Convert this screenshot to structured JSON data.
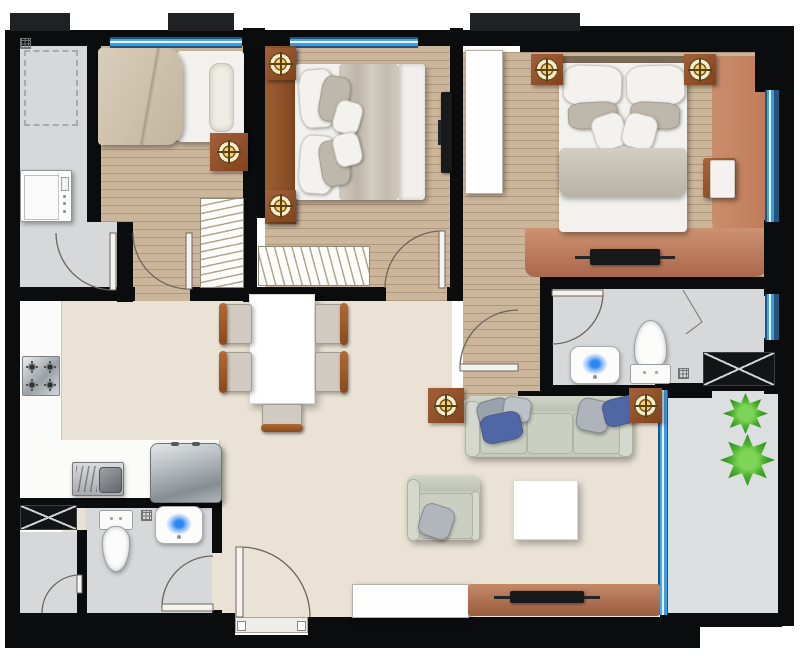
{
  "meta": {
    "canvas": {
      "w": 800,
      "h": 667
    },
    "view": "apartment-floor-plan-top-view"
  },
  "palette": {
    "wall": "#0b0c0d",
    "window_blue": "#3d9be0",
    "wood_floor": "#cbb69b",
    "tile_floor": "#d6d8da",
    "living_floor": "#eae3d5",
    "balcony_floor": "#dcdfe0",
    "accent_wood": "#a2613a",
    "light_gold": "#f6d164",
    "sofa_fabric": "#c6cabc",
    "pillow_blue": "#4f68a5",
    "plant_green": "#35961f",
    "rug_salmon": "#bf7a57"
  },
  "floorplan": {
    "floors": [
      {
        "n": "utility-room-floor",
        "c": "fl-gray",
        "x": 20,
        "y": 35,
        "w": 98,
        "h": 266
      },
      {
        "n": "bedroom1-floor",
        "c": "fl-wood",
        "x": 101,
        "y": 45,
        "w": 142,
        "h": 257
      },
      {
        "n": "vestibule-floor",
        "c": "fl-gray",
        "x": 101,
        "y": 222,
        "w": 32,
        "h": 80
      },
      {
        "n": "bedroom2-floor",
        "c": "fl-wood",
        "x": 265,
        "y": 44,
        "w": 185,
        "h": 258
      },
      {
        "n": "master-bedroom-floor",
        "c": "fl-wood",
        "x": 463,
        "y": 52,
        "w": 315,
        "h": 237
      },
      {
        "n": "hallway-floor",
        "c": "fl-wood",
        "x": 463,
        "y": 289,
        "w": 77,
        "h": 111
      },
      {
        "n": "bathroom1-floor",
        "c": "fl-gray",
        "x": 553,
        "y": 289,
        "w": 225,
        "h": 97
      },
      {
        "n": "living-floor-upper",
        "c": "fl-beige",
        "x": 62,
        "y": 301,
        "w": 390,
        "h": 99
      },
      {
        "n": "living-floor-main",
        "c": "fl-beige",
        "x": 62,
        "y": 400,
        "w": 597,
        "h": 230
      },
      {
        "n": "balcony-floor",
        "c": "fl-balcony",
        "x": 668,
        "y": 391,
        "w": 110,
        "h": 222
      },
      {
        "n": "kitchen-counter-vertical",
        "c": "fl-counter",
        "x": 20,
        "y": 298,
        "w": 42,
        "h": 202
      },
      {
        "n": "kitchen-counter-horizontal",
        "c": "fl-counter",
        "x": 20,
        "y": 440,
        "w": 200,
        "h": 60
      },
      {
        "n": "bathroom2-floor",
        "c": "fl-gray",
        "x": 85,
        "y": 503,
        "w": 127,
        "h": 115
      },
      {
        "n": "shower-room-floor",
        "c": "fl-gray",
        "x": 20,
        "y": 532,
        "w": 57,
        "h": 86
      },
      {
        "n": "master-rug-column",
        "c": "salmon-col",
        "x": 712,
        "y": 56,
        "w": 58,
        "h": 184
      },
      {
        "n": "master-rug-band",
        "c": "salmon-band",
        "x": 525,
        "y": 228,
        "w": 245,
        "h": 49
      }
    ],
    "walls": [
      {
        "n": "wall-left",
        "x": 5,
        "y": 30,
        "w": 15,
        "h": 618
      },
      {
        "n": "wall-top-a",
        "x": 5,
        "y": 30,
        "w": 515,
        "h": 16
      },
      {
        "n": "wall-top-b",
        "x": 520,
        "y": 26,
        "w": 272,
        "h": 26
      },
      {
        "n": "wall-right",
        "x": 778,
        "y": 26,
        "w": 16,
        "h": 600
      },
      {
        "n": "wall-corner-tr",
        "x": 755,
        "y": 26,
        "w": 39,
        "h": 66
      },
      {
        "n": "wall-right-mid",
        "x": 764,
        "y": 220,
        "w": 30,
        "h": 76
      },
      {
        "n": "wall-right-low",
        "x": 764,
        "y": 338,
        "w": 30,
        "h": 56
      },
      {
        "n": "wall-bottom-left",
        "x": 5,
        "y": 613,
        "w": 230,
        "h": 35
      },
      {
        "n": "wall-bottom-mid",
        "x": 308,
        "y": 617,
        "w": 392,
        "h": 31
      },
      {
        "n": "wall-under-entrance",
        "x": 235,
        "y": 635,
        "w": 75,
        "h": 13
      },
      {
        "n": "wall-balcony-bottom",
        "x": 660,
        "y": 613,
        "w": 122,
        "h": 14
      },
      {
        "n": "wall-utility-right",
        "x": 87,
        "y": 30,
        "w": 14,
        "h": 192
      },
      {
        "n": "wall-vestibule-right",
        "x": 117,
        "y": 222,
        "w": 16,
        "h": 80
      },
      {
        "n": "wall-utility-bottom",
        "x": 5,
        "y": 287,
        "w": 130,
        "h": 14
      },
      {
        "n": "wall-bed1-bed2",
        "x": 243,
        "y": 28,
        "w": 22,
        "h": 190
      },
      {
        "n": "wall-bed1-bed2-low",
        "x": 243,
        "y": 218,
        "w": 14,
        "h": 84
      },
      {
        "n": "wall-bed2-bottom",
        "x": 190,
        "y": 287,
        "w": 196,
        "h": 14
      },
      {
        "n": "wall-bed2-corner",
        "x": 447,
        "y": 287,
        "w": 16,
        "h": 14
      },
      {
        "n": "wall-bed2-master",
        "x": 450,
        "y": 28,
        "w": 13,
        "h": 260
      },
      {
        "n": "wall-hall-bath",
        "x": 540,
        "y": 288,
        "w": 13,
        "h": 112
      },
      {
        "n": "wall-master-bath",
        "x": 540,
        "y": 277,
        "w": 242,
        "h": 12
      },
      {
        "n": "wall-bath1-bottom",
        "x": 540,
        "y": 385,
        "w": 172,
        "h": 13
      },
      {
        "n": "wall-balcony-top",
        "x": 655,
        "y": 383,
        "w": 127,
        "h": 8
      },
      {
        "n": "wall-bath2-top",
        "x": 5,
        "y": 498,
        "w": 213,
        "h": 10
      },
      {
        "n": "wall-bath2-right-a",
        "x": 212,
        "y": 498,
        "w": 10,
        "h": 55
      },
      {
        "n": "wall-bath2-right-b",
        "x": 212,
        "y": 610,
        "w": 10,
        "h": 8
      },
      {
        "n": "wall-shower-divider",
        "x": 77,
        "y": 530,
        "w": 10,
        "h": 88
      },
      {
        "n": "wall-hall-bottom",
        "x": 518,
        "y": 391,
        "w": 24,
        "h": 9
      }
    ],
    "pillars": [
      {
        "x": 10,
        "y": 13,
        "w": 60,
        "h": 18
      },
      {
        "x": 168,
        "y": 13,
        "w": 66,
        "h": 18
      },
      {
        "x": 470,
        "y": 13,
        "w": 110,
        "h": 18
      }
    ],
    "windows": [
      {
        "n": "window-bedroom1",
        "x": 110,
        "y": 37,
        "w": 132,
        "h": 11,
        "o": "h"
      },
      {
        "n": "window-bedroom2",
        "x": 290,
        "y": 37,
        "w": 128,
        "h": 11,
        "o": "h"
      },
      {
        "n": "window-master",
        "x": 765,
        "y": 90,
        "w": 14,
        "h": 132,
        "o": "v"
      },
      {
        "n": "window-bathroom1",
        "x": 765,
        "y": 294,
        "w": 14,
        "h": 46,
        "o": "v"
      },
      {
        "n": "window-balcony",
        "x": 658,
        "y": 390,
        "w": 10,
        "h": 225,
        "o": "v"
      }
    ],
    "shafts": [
      {
        "n": "duct-shaft-bathroom1",
        "x": 703,
        "y": 352,
        "w": 72,
        "h": 34
      },
      {
        "n": "duct-shaft-bathroom2",
        "x": 20,
        "y": 505,
        "w": 57,
        "h": 25
      }
    ],
    "lights": [
      {
        "n": "ceiling-light-bedroom1",
        "x": 210,
        "y": 133,
        "w": 38,
        "h": 38
      },
      {
        "n": "ceiling-light-bedroom2-top",
        "x": 265,
        "y": 48,
        "w": 31,
        "h": 32
      },
      {
        "n": "ceiling-light-bedroom2-bottom",
        "x": 265,
        "y": 190,
        "w": 31,
        "h": 32
      },
      {
        "n": "ceiling-light-master-left",
        "x": 531,
        "y": 54,
        "w": 32,
        "h": 31
      },
      {
        "n": "ceiling-light-master-right",
        "x": 684,
        "y": 54,
        "w": 32,
        "h": 31
      },
      {
        "n": "ceiling-light-living-left",
        "x": 428,
        "y": 388,
        "w": 36,
        "h": 35
      },
      {
        "n": "ceiling-light-living-right",
        "x": 629,
        "y": 388,
        "w": 33,
        "h": 35
      }
    ],
    "doors": [
      {
        "n": "door-utility",
        "leaf": {
          "x": 110,
          "y": 233,
          "w": 6,
          "h": 57
        },
        "arc": "M113,290 A57 57 0 0 1 56,233"
      },
      {
        "n": "door-bedroom1",
        "leaf": {
          "x": 186,
          "y": 233,
          "w": 6,
          "h": 56
        },
        "arc": "M189,289 A56 56 0 0 1 133,233"
      },
      {
        "n": "door-bedroom2",
        "leaf": {
          "x": 439,
          "y": 231,
          "w": 6,
          "h": 57
        },
        "arc": "M442,231 A57 57 0 0 0 385,288"
      },
      {
        "n": "door-master",
        "leaf": {
          "x": 460,
          "y": 364,
          "w": 58,
          "h": 7
        },
        "arc": "M460,368 A58 58 0 0 1 518,310"
      },
      {
        "n": "door-bathroom1",
        "leaf": {
          "x": 552,
          "y": 290,
          "w": 51,
          "h": 6
        },
        "arc": "M603,293 A51 51 0 0 1 552,344"
      },
      {
        "n": "door-entrance",
        "leaf": {
          "x": 236,
          "y": 547,
          "w": 7,
          "h": 70
        },
        "arc": "M240,547 A70 70 0 0 1 310,617"
      },
      {
        "n": "door-bathroom2",
        "leaf": {
          "x": 162,
          "y": 604,
          "w": 51,
          "h": 7
        },
        "arc": "M162,607 A51 51 0 0 1 213,556"
      },
      {
        "n": "door-shower-room",
        "leaf": {
          "x": 77,
          "y": 575,
          "w": 5,
          "h": 18
        },
        "arc": "M80,575 A38 38 0 0 0 42,613"
      }
    ],
    "lines": [
      {
        "n": "shower-screen-line",
        "d": "M683,290 L702,322 L686,334"
      }
    ],
    "furniture": [
      {
        "t": "dashed",
        "n": "utility-appliance-outline",
        "x": 24,
        "y": 50,
        "w": 54,
        "h": 76
      },
      {
        "t": "drain",
        "n": "utility-meter-grid",
        "x": 20,
        "y": 38,
        "w": 11,
        "h": 11
      },
      {
        "t": "washer",
        "n": "washing-machine",
        "x": 20,
        "y": 170,
        "w": 52,
        "h": 52
      },
      {
        "t": "bed1",
        "n": "single-bed",
        "x": 98,
        "y": 48,
        "w": 146,
        "h": 97
      },
      {
        "t": "ward",
        "n": "wardrobe-bedroom1",
        "x": 200,
        "y": 198,
        "w": 44,
        "h": 90,
        "o": "v"
      },
      {
        "t": "ward",
        "n": "wardrobe-closet",
        "x": 258,
        "y": 246,
        "w": 112,
        "h": 40,
        "o": "h"
      },
      {
        "t": "box",
        "c": "headboard",
        "n": "bedroom2-headboard-panel",
        "x": 265,
        "y": 46,
        "w": 31,
        "h": 178
      },
      {
        "t": "bed2",
        "n": "double-bed",
        "x": 295,
        "y": 64,
        "w": 130,
        "h": 136
      },
      {
        "t": "tvv",
        "n": "tv-bedroom2",
        "x": 441,
        "y": 92,
        "w": 11,
        "h": 81
      },
      {
        "t": "box",
        "c": "cab-white",
        "n": "wardrobe-master",
        "x": 465,
        "y": 50,
        "w": 38,
        "h": 144
      },
      {
        "t": "bedm",
        "n": "master-bed",
        "x": 558,
        "y": 56,
        "w": 130,
        "h": 176
      },
      {
        "t": "sidetable",
        "n": "master-side-table",
        "x": 703,
        "y": 158,
        "w": 33,
        "h": 40
      },
      {
        "t": "tvh",
        "n": "tv-master",
        "x": 590,
        "y": 249,
        "w": 70,
        "h": 16
      },
      {
        "t": "bsink",
        "n": "bathroom1-sink",
        "x": 570,
        "y": 346,
        "w": 50,
        "h": 38
      },
      {
        "t": "toilet",
        "n": "bathroom1-toilet",
        "x": 630,
        "y": 320,
        "w": 39,
        "h": 64,
        "o": "s"
      },
      {
        "t": "drain",
        "n": "bathroom1-floor-drain",
        "x": 678,
        "y": 368,
        "w": 11,
        "h": 11
      },
      {
        "t": "table",
        "n": "dining-table",
        "x": 249,
        "y": 294,
        "w": 66,
        "h": 110
      },
      {
        "t": "chair",
        "n": "dining-chair-1",
        "x": 222,
        "y": 304,
        "w": 30,
        "h": 40,
        "d": "l"
      },
      {
        "t": "chair",
        "n": "dining-chair-2",
        "x": 222,
        "y": 352,
        "w": 30,
        "h": 40,
        "d": "l"
      },
      {
        "t": "chair",
        "n": "dining-chair-3",
        "x": 315,
        "y": 304,
        "w": 30,
        "h": 40,
        "d": "r"
      },
      {
        "t": "chair",
        "n": "dining-chair-4",
        "x": 315,
        "y": 352,
        "w": 30,
        "h": 40,
        "d": "r"
      },
      {
        "t": "chair",
        "n": "dining-chair-5",
        "x": 262,
        "y": 404,
        "w": 40,
        "h": 25,
        "d": "b"
      },
      {
        "t": "stove",
        "n": "cooktop",
        "x": 22,
        "y": 356,
        "w": 38,
        "h": 40
      },
      {
        "t": "ksink",
        "n": "kitchen-sink",
        "x": 72,
        "y": 462,
        "w": 52,
        "h": 34
      },
      {
        "t": "fridge",
        "n": "refrigerator",
        "x": 150,
        "y": 443,
        "w": 72,
        "h": 60
      },
      {
        "t": "sofa",
        "n": "sofa",
        "x": 465,
        "y": 396,
        "w": 168,
        "h": 61
      },
      {
        "t": "pillow",
        "n": "sofa-pillow-gray-1",
        "x": 478,
        "y": 399,
        "w": 33,
        "h": 33,
        "r": -15,
        "col": "#9aa2ab"
      },
      {
        "t": "pillow",
        "n": "sofa-pillow-gray-2",
        "x": 503,
        "y": 397,
        "w": 28,
        "h": 25,
        "r": 8,
        "col": "#bcc2c7"
      },
      {
        "t": "pillow",
        "n": "sofa-pillow-blue-1",
        "x": 481,
        "y": 413,
        "w": 41,
        "h": 29,
        "r": -12,
        "col": "#4f68a5"
      },
      {
        "t": "pillow",
        "n": "sofa-pillow-gray-3",
        "x": 577,
        "y": 399,
        "w": 33,
        "h": 33,
        "r": 12,
        "col": "#aeb4ba"
      },
      {
        "t": "pillow",
        "n": "sofa-pillow-blue-2",
        "x": 603,
        "y": 397,
        "w": 37,
        "h": 28,
        "r": -14,
        "col": "#4f68a5"
      },
      {
        "t": "armchair",
        "n": "armchair",
        "x": 407,
        "y": 475,
        "w": 73,
        "h": 65
      },
      {
        "t": "pillow",
        "n": "armchair-pillow",
        "x": 420,
        "y": 505,
        "w": 33,
        "h": 33,
        "r": 18,
        "col": "#b0b6bb"
      },
      {
        "t": "table",
        "n": "coffee-table",
        "x": 513,
        "y": 480,
        "w": 65,
        "h": 60
      },
      {
        "t": "box",
        "c": "cab-white",
        "n": "tv-cabinet",
        "x": 352,
        "y": 584,
        "w": 117,
        "h": 34
      },
      {
        "t": "media",
        "n": "media-console",
        "x": 468,
        "y": 584,
        "w": 192,
        "h": 32
      },
      {
        "t": "tvh",
        "n": "tv-living",
        "x": 510,
        "y": 591,
        "w": 74,
        "h": 12
      },
      {
        "t": "sill",
        "n": "entrance-sill",
        "x": 235,
        "y": 617,
        "w": 73,
        "h": 16
      },
      {
        "t": "toilet",
        "n": "bathroom2-toilet",
        "x": 99,
        "y": 510,
        "w": 32,
        "h": 60,
        "o": "n"
      },
      {
        "t": "bsink",
        "n": "bathroom2-sink",
        "x": 155,
        "y": 506,
        "w": 48,
        "h": 38
      },
      {
        "t": "drain",
        "n": "bathroom2-floor-drain",
        "x": 141,
        "y": 510,
        "w": 11,
        "h": 11
      },
      {
        "t": "plant",
        "n": "plant-1",
        "x": 723,
        "y": 393,
        "w": 45,
        "h": 41
      },
      {
        "t": "plant",
        "n": "plant-2",
        "x": 720,
        "y": 434,
        "w": 55,
        "h": 52
      }
    ]
  }
}
